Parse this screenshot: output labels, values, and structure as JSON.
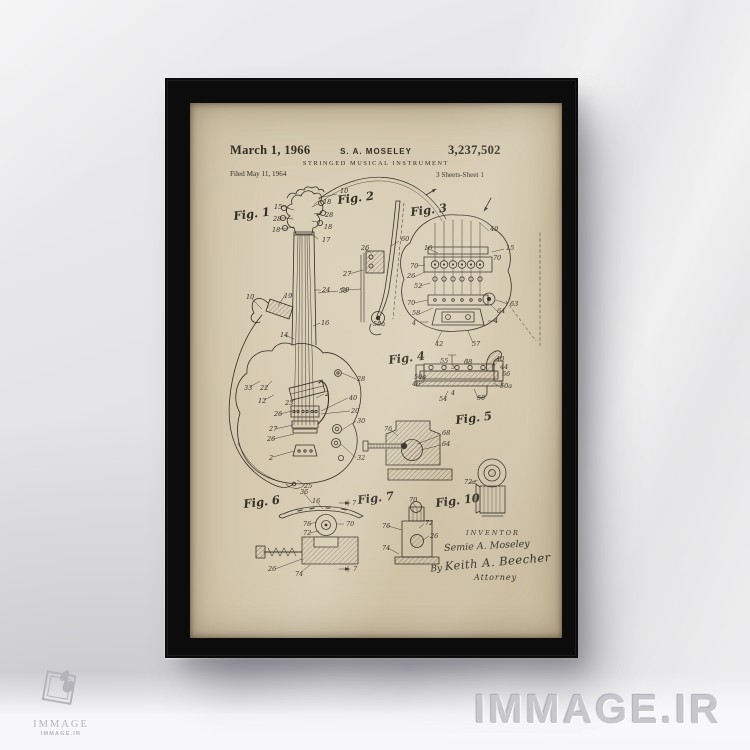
{
  "scene": {
    "wall_color": "#e2e2e4",
    "floor_color": "#f6f6f8",
    "frame_color": "#0c0c0c",
    "paper_color": "#d7cbb1",
    "ink_color": "#332e24",
    "watermark_color": "#c8c8cc"
  },
  "watermarks": {
    "brand_text": "IMMAGE.IR",
    "logo_title": "IMMAGE",
    "logo_subtitle": "IMMAGE.IR",
    "logo_mark": "flame-diamond"
  },
  "patent": {
    "date": "March 1, 1966",
    "inventor_name": "S. A. MOSELEY",
    "number": "3,237,502",
    "title": "STRINGED MUSICAL INSTRUMENT",
    "filed_line": "Filed May 11, 1964",
    "sheet_line": "3 Sheets-Sheet 1",
    "inventor_block": {
      "heading": "INVENTOR",
      "name": "Semie A. Moseley",
      "by_prefix": "By",
      "signature": "Keith A. Beecher",
      "role": "Attorney"
    },
    "figures": [
      {
        "label": "Fig. 1",
        "x": 44,
        "y": 117
      },
      {
        "label": "Fig. 2",
        "x": 148,
        "y": 101
      },
      {
        "label": "Fig. 3",
        "x": 221,
        "y": 113
      },
      {
        "label": "Fig. 4",
        "x": 199,
        "y": 261
      },
      {
        "label": "Fig. 5",
        "x": 266,
        "y": 321
      },
      {
        "label": "Fig. 6",
        "x": 54,
        "y": 405
      },
      {
        "label": "Fig. 7",
        "x": 168,
        "y": 401
      },
      {
        "label": "Fig. 10",
        "x": 246,
        "y": 404
      }
    ],
    "annotations": [
      {
        "t": "15",
        "x": 84,
        "y": 106
      },
      {
        "t": "28",
        "x": 83,
        "y": 118
      },
      {
        "t": "18",
        "x": 82,
        "y": 129
      },
      {
        "t": "10",
        "x": 150,
        "y": 90
      },
      {
        "t": "18",
        "x": 133,
        "y": 101
      },
      {
        "t": "28",
        "x": 135,
        "y": 114
      },
      {
        "t": "18",
        "x": 134,
        "y": 126
      },
      {
        "t": "17",
        "x": 132,
        "y": 139
      },
      {
        "t": "24",
        "x": 132,
        "y": 189
      },
      {
        "t": "50",
        "x": 149,
        "y": 190
      },
      {
        "t": "19",
        "x": 94,
        "y": 195
      },
      {
        "t": "10",
        "x": 56,
        "y": 196
      },
      {
        "t": "16",
        "x": 131,
        "y": 222
      },
      {
        "t": "14",
        "x": 90,
        "y": 234
      },
      {
        "t": "33",
        "x": 54,
        "y": 287
      },
      {
        "t": "22",
        "x": 70,
        "y": 287
      },
      {
        "t": "12",
        "x": 68,
        "y": 300
      },
      {
        "t": "23",
        "x": 95,
        "y": 302
      },
      {
        "t": "26",
        "x": 84,
        "y": 313
      },
      {
        "t": "27",
        "x": 79,
        "y": 328
      },
      {
        "t": "26",
        "x": 77,
        "y": 338
      },
      {
        "t": "2",
        "x": 79,
        "y": 357
      },
      {
        "t": "25",
        "x": 114,
        "y": 385
      },
      {
        "t": "36",
        "x": 110,
        "y": 391
      },
      {
        "t": "2",
        "x": 135,
        "y": 293
      },
      {
        "t": "40",
        "x": 159,
        "y": 297
      },
      {
        "t": "20",
        "x": 161,
        "y": 310
      },
      {
        "t": "30",
        "x": 167,
        "y": 320
      },
      {
        "t": "32",
        "x": 167,
        "y": 357
      },
      {
        "t": "28",
        "x": 167,
        "y": 278
      },
      {
        "t": "26",
        "x": 171,
        "y": 147
      },
      {
        "t": "27",
        "x": 153,
        "y": 173
      },
      {
        "t": "50",
        "x": 151,
        "y": 189
      },
      {
        "t": "60",
        "x": 211,
        "y": 138
      },
      {
        "t": "50a",
        "x": 183,
        "y": 223
      },
      {
        "t": "49",
        "x": 300,
        "y": 128
      },
      {
        "t": "15",
        "x": 316,
        "y": 147
      },
      {
        "t": "16",
        "x": 234,
        "y": 147
      },
      {
        "t": "70",
        "x": 303,
        "y": 157
      },
      {
        "t": "70",
        "x": 220,
        "y": 165
      },
      {
        "t": "26",
        "x": 217,
        "y": 175
      },
      {
        "t": "52",
        "x": 224,
        "y": 185
      },
      {
        "t": "70",
        "x": 217,
        "y": 202
      },
      {
        "t": "58",
        "x": 222,
        "y": 212
      },
      {
        "t": "63",
        "x": 320,
        "y": 203
      },
      {
        "t": "64",
        "x": 307,
        "y": 210
      },
      {
        "t": "4",
        "x": 222,
        "y": 222
      },
      {
        "t": "4",
        "x": 304,
        "y": 220
      },
      {
        "t": "42",
        "x": 245,
        "y": 243
      },
      {
        "t": "57",
        "x": 282,
        "y": 243
      },
      {
        "t": "55",
        "x": 250,
        "y": 260
      },
      {
        "t": "5",
        "x": 261,
        "y": 266
      },
      {
        "t": "68",
        "x": 274,
        "y": 261
      },
      {
        "t": "40",
        "x": 306,
        "y": 258
      },
      {
        "t": "44",
        "x": 310,
        "y": 266
      },
      {
        "t": "66",
        "x": 312,
        "y": 273
      },
      {
        "t": "50a",
        "x": 224,
        "y": 276
      },
      {
        "t": "46",
        "x": 222,
        "y": 283
      },
      {
        "t": "50a",
        "x": 310,
        "y": 285
      },
      {
        "t": "54",
        "x": 249,
        "y": 298
      },
      {
        "t": "4",
        "x": 261,
        "y": 292
      },
      {
        "t": "50",
        "x": 287,
        "y": 297
      },
      {
        "t": "76",
        "x": 194,
        "y": 328
      },
      {
        "t": "68",
        "x": 252,
        "y": 332
      },
      {
        "t": "64",
        "x": 252,
        "y": 343
      },
      {
        "t": "72a",
        "x": 274,
        "y": 381
      },
      {
        "t": "16",
        "x": 122,
        "y": 400
      },
      {
        "t": "7",
        "x": 162,
        "y": 402
      },
      {
        "t": "76",
        "x": 113,
        "y": 423
      },
      {
        "t": "70",
        "x": 156,
        "y": 423
      },
      {
        "t": "72",
        "x": 113,
        "y": 432
      },
      {
        "t": "26",
        "x": 78,
        "y": 468
      },
      {
        "t": "74",
        "x": 105,
        "y": 473
      },
      {
        "t": "7",
        "x": 163,
        "y": 468
      },
      {
        "t": "70",
        "x": 219,
        "y": 399
      },
      {
        "t": "76",
        "x": 192,
        "y": 425
      },
      {
        "t": "72",
        "x": 235,
        "y": 422
      },
      {
        "t": "26",
        "x": 240,
        "y": 435
      },
      {
        "t": "74",
        "x": 192,
        "y": 447
      }
    ]
  }
}
